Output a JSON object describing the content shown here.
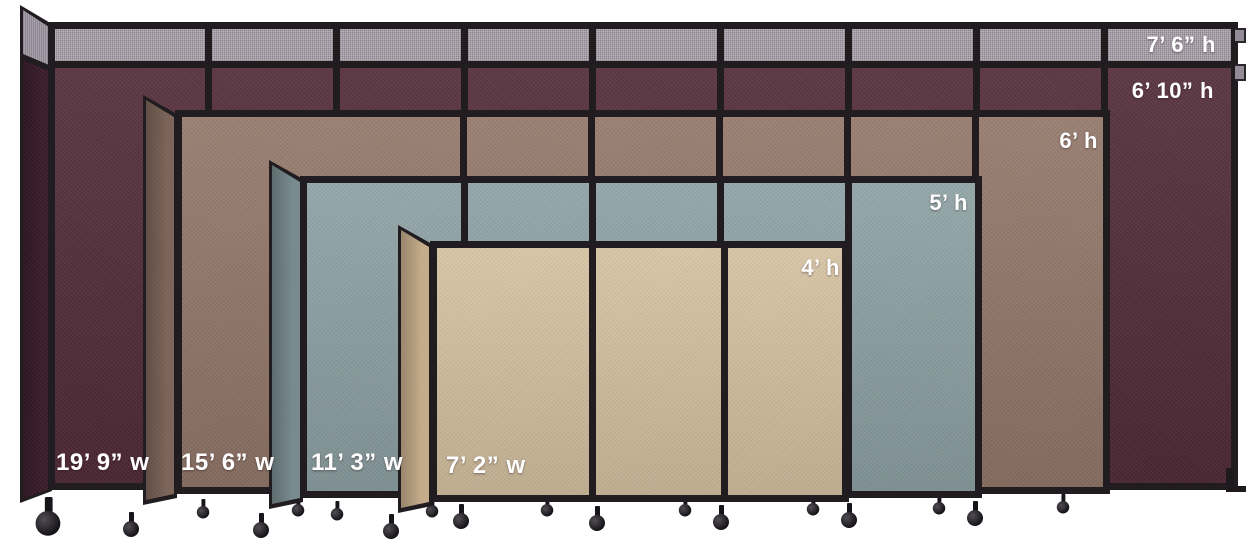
{
  "image_type": "room-divider-size-comparison",
  "colors": {
    "background": "#ffffff",
    "frame": "#201c1f",
    "extension_panel": "#a49ba5",
    "extension_panel_shaded": "#8f8793"
  },
  "partitions": [
    {
      "fabric_color": "#522b38",
      "fabric_color_shaded": "#3a1d29",
      "extension_height_label": "7’ 6” h",
      "height_label": "6’ 10” h",
      "width_label": "19’ 9” w"
    },
    {
      "fabric_color": "#937769",
      "fabric_color_shaded": "#7a6257",
      "height_label": "6’ h",
      "width_label": "15’ 6” w"
    },
    {
      "fabric_color": "#8da1a4",
      "fabric_color_shaded": "#76898d",
      "height_label": "5’ h",
      "width_label": "11’ 3” w"
    },
    {
      "fabric_color": "#d6c2a1",
      "fabric_color_shaded": "#c3aa88",
      "height_label": "4’ h",
      "width_label": "7’ 2” w"
    }
  ]
}
